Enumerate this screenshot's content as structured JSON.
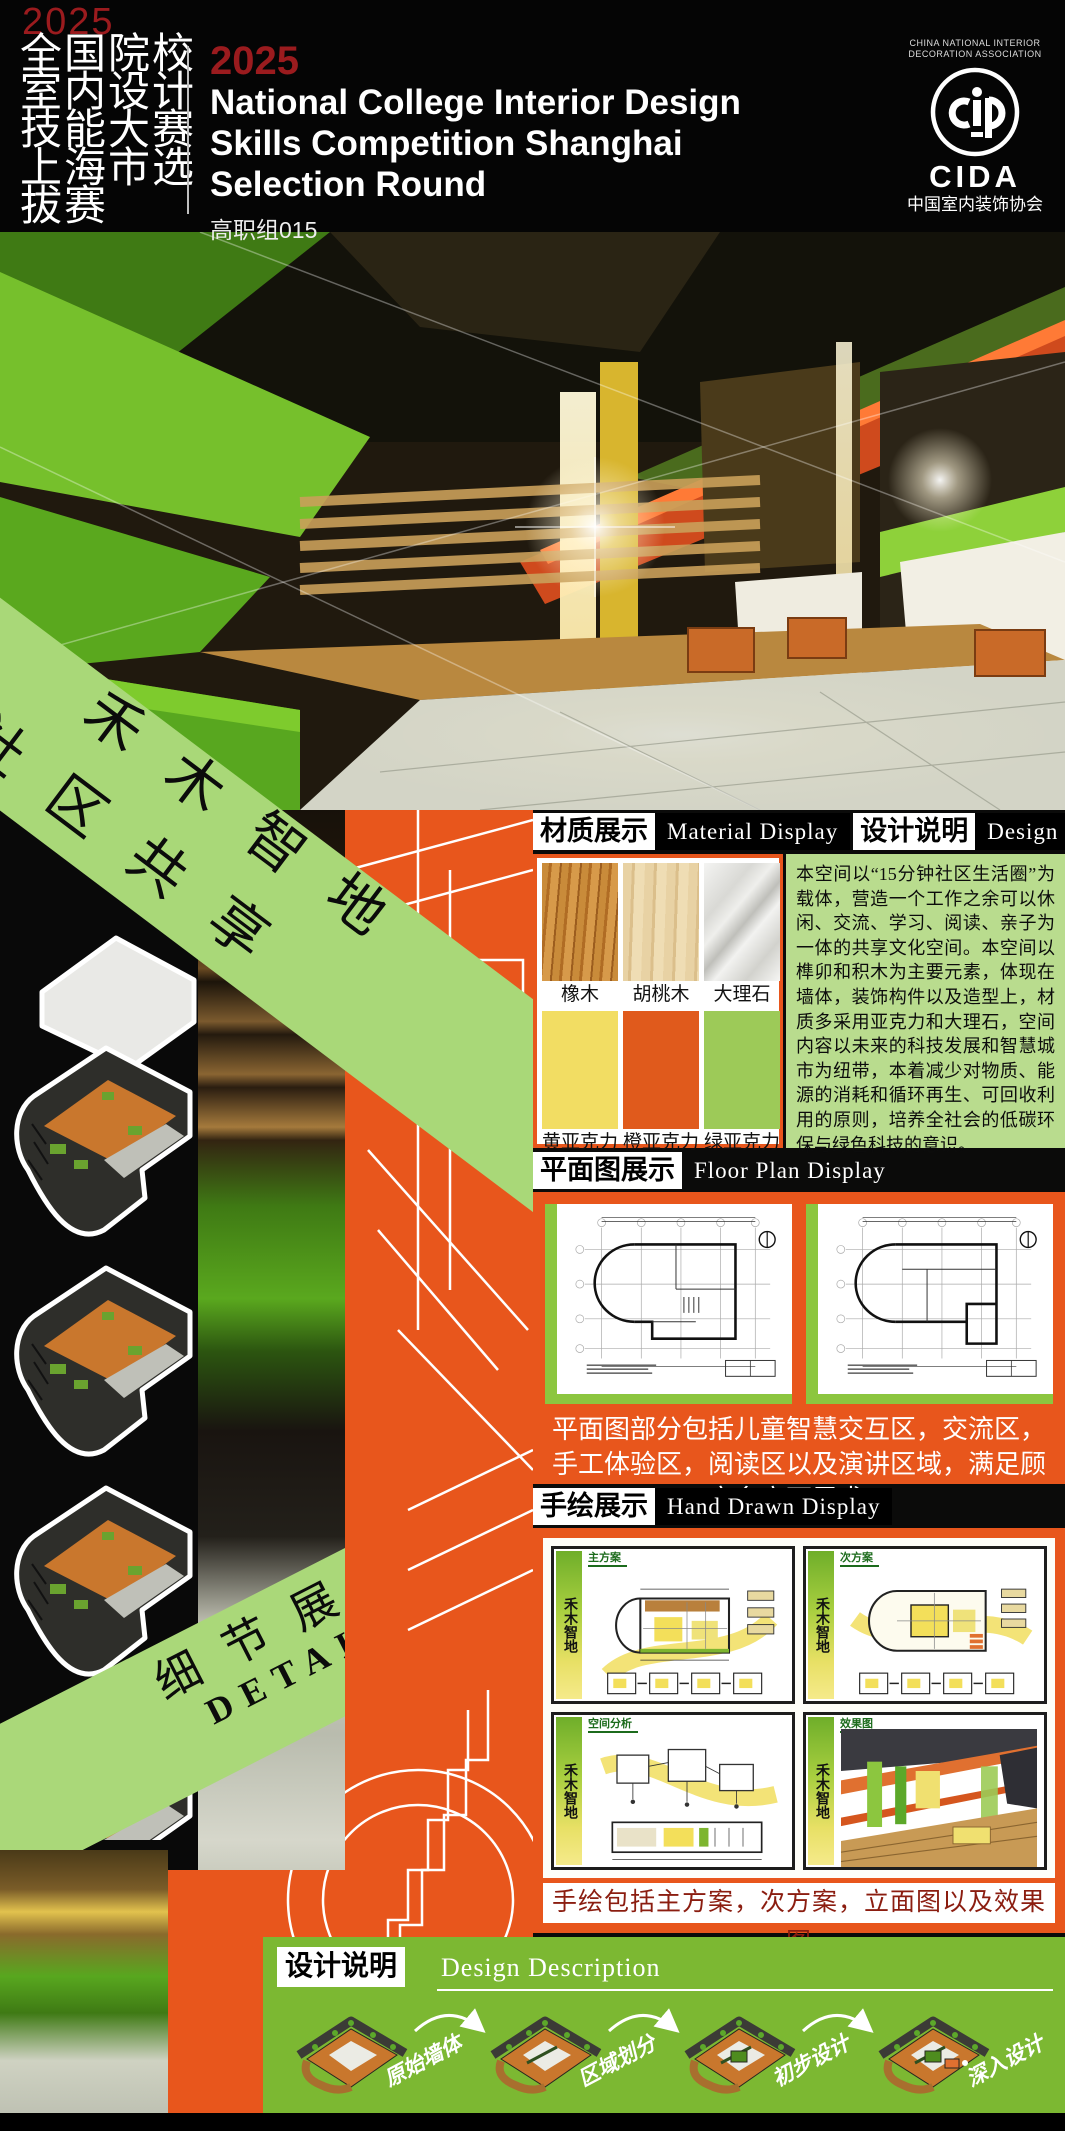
{
  "header": {
    "year": "2025",
    "cn_title_rows": [
      "全国院校",
      "室内设计",
      "技能大赛",
      "上海市选",
      "拔赛"
    ],
    "en_year": "2025",
    "en_title_lines": [
      "National College Interior Design",
      "Skills Competition Shanghai",
      "Selection Round"
    ],
    "group_label": "高职组015",
    "cida": {
      "assoc_en_line1": "CHINA NATIONAL INTERIOR",
      "assoc_en_line2": "DECORATION ASSOCIATION",
      "acronym": "CIDA",
      "assoc_cn": "中国室内装饰协会"
    }
  },
  "banners": {
    "main_line1": "禾木智地",
    "main_line2": "社区共享",
    "details_cn": "细节展示",
    "details_en": "DETAILS"
  },
  "sections": {
    "material": {
      "cn": "材质展示",
      "en": "Material Display",
      "samples": [
        {
          "label": "橡木"
        },
        {
          "label": "胡桃木"
        },
        {
          "label": "大理石"
        }
      ],
      "swatches": [
        {
          "label": "黄亚克力",
          "color": "#f2dd63"
        },
        {
          "label": "橙亚克力",
          "color": "#e05a1c"
        },
        {
          "label": "绿亚克力",
          "color": "#9dca58"
        }
      ]
    },
    "description": {
      "cn": "设计说明",
      "en": "Design Description",
      "text": "本空间以“15分钟社区生活圈”为载体，营造一个工作之余可以休闲、交流、学习、阅读、亲子为一体的共享文化空间。本空间以榫卯和积木为主要元素，体现在墙体，装饰构件以及造型上，材质多采用亚克力和大理石，空间内容以未来的科技发展和智慧城市为纽带，本着减少对物质、能源的消耗和循环再生、可回收利用的原则，培养全社会的低碳环保与绿色科技的意识。"
    },
    "floor_plan": {
      "cn": "平面图展示",
      "en": "Floor Plan Display",
      "caption": "平面图部分包括儿童智慧交互区，交流区，手工体验区，阅读区以及演讲区域，满足顾客多方面需求。"
    },
    "hand_drawn": {
      "cn": "手绘展示",
      "en": "Hand Drawn Display",
      "logo_text": "禾木智地",
      "sketch_titles": [
        "主方案",
        "次方案",
        "空间分析",
        "效果图"
      ],
      "caption": "手绘包括主方案，次方案，立面图以及效果图"
    },
    "process": {
      "cn": "设计说明",
      "en": "Design Description",
      "steps": [
        "原始墙体",
        "区域划分",
        "初步设计",
        "深入设计"
      ]
    }
  },
  "palette": {
    "accent_orange": "#e8561c",
    "banner_light_green": "#a9d878",
    "process_green": "#7cb832",
    "description_green": "#b9dc8e",
    "plan_border_green": "#8cc63f",
    "title_red": "#9b1b1e",
    "caption_dark_red": "#8b1d10"
  }
}
